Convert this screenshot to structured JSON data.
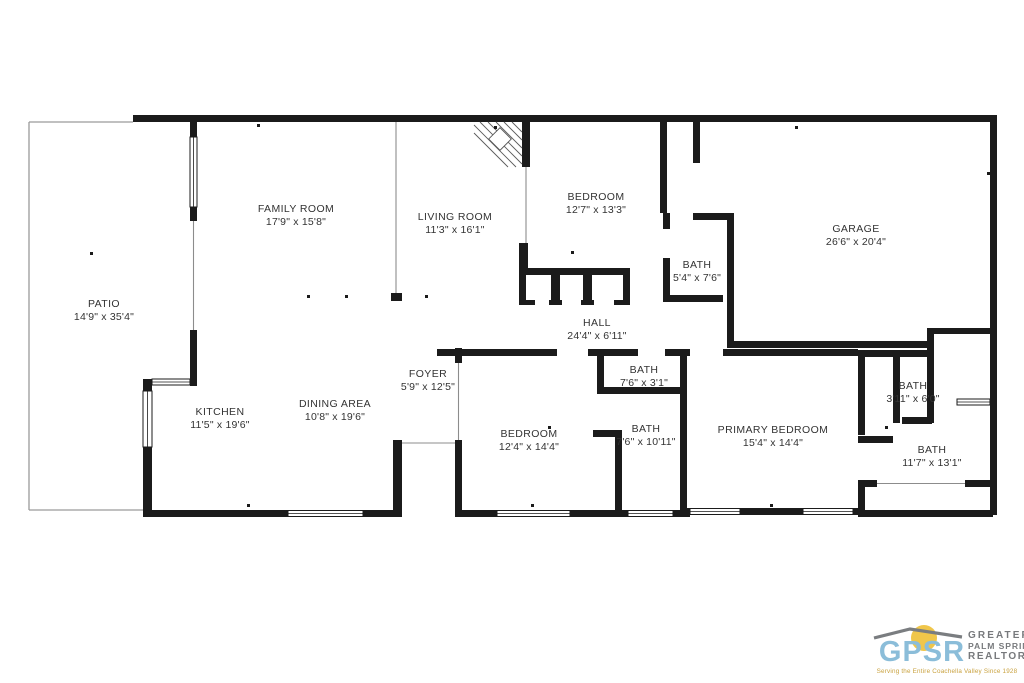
{
  "rooms": [
    {
      "id": "patio",
      "name": "PATIO",
      "dims": "14'9\" x 35'4\""
    },
    {
      "id": "family",
      "name": "FAMILY ROOM",
      "dims": "17'9\" x 15'8\""
    },
    {
      "id": "living",
      "name": "LIVING ROOM",
      "dims": "11'3\" x 16'1\""
    },
    {
      "id": "bed-top",
      "name": "BEDROOM",
      "dims": "12'7\" x 13'3\""
    },
    {
      "id": "garage",
      "name": "GARAGE",
      "dims": "26'6\" x 20'4\""
    },
    {
      "id": "bath54",
      "name": "BATH",
      "dims": "5'4\" x 7'6\""
    },
    {
      "id": "hall",
      "name": "HALL",
      "dims": "24'4\" x 6'11\""
    },
    {
      "id": "foyer",
      "name": "FOYER",
      "dims": "5'9\" x 12'5\""
    },
    {
      "id": "kitchen",
      "name": "KITCHEN",
      "dims": "11'5\" x 19'6\""
    },
    {
      "id": "dining",
      "name": "DINING AREA",
      "dims": "10'8\" x 19'6\""
    },
    {
      "id": "bath763",
      "name": "BATH",
      "dims": "7'6\" x 3'1\""
    },
    {
      "id": "bed-bottom",
      "name": "BEDROOM",
      "dims": "12'4\" x 14'4\""
    },
    {
      "id": "bath71011",
      "name": "BATH",
      "dims": "7'6\" x 10'11\""
    },
    {
      "id": "primary",
      "name": "PRIMARY BEDROOM",
      "dims": "15'4\" x 14'4\""
    },
    {
      "id": "bath-small",
      "name": "BATH",
      "dims": "3'11\" x 6'0\""
    },
    {
      "id": "bath117",
      "name": "BATH",
      "dims": "11'7\" x 13'1\""
    }
  ],
  "logo": {
    "acronym": "GPSR",
    "org_line1": "GREATER",
    "org_line2": "PALM SPRINGS",
    "org_line3": "REALTORS®",
    "tagline": "Serving the Entire Coachella Valley Since 1928",
    "colors": {
      "acronym_blue": "#8bbdd9",
      "sun_yellow": "#f0c64a",
      "swoosh_gray": "#7a7d80",
      "org_text_gray": "#77797c",
      "tagline_gold": "#c9a23f",
      "wall_black": "#1b1b1b"
    }
  }
}
